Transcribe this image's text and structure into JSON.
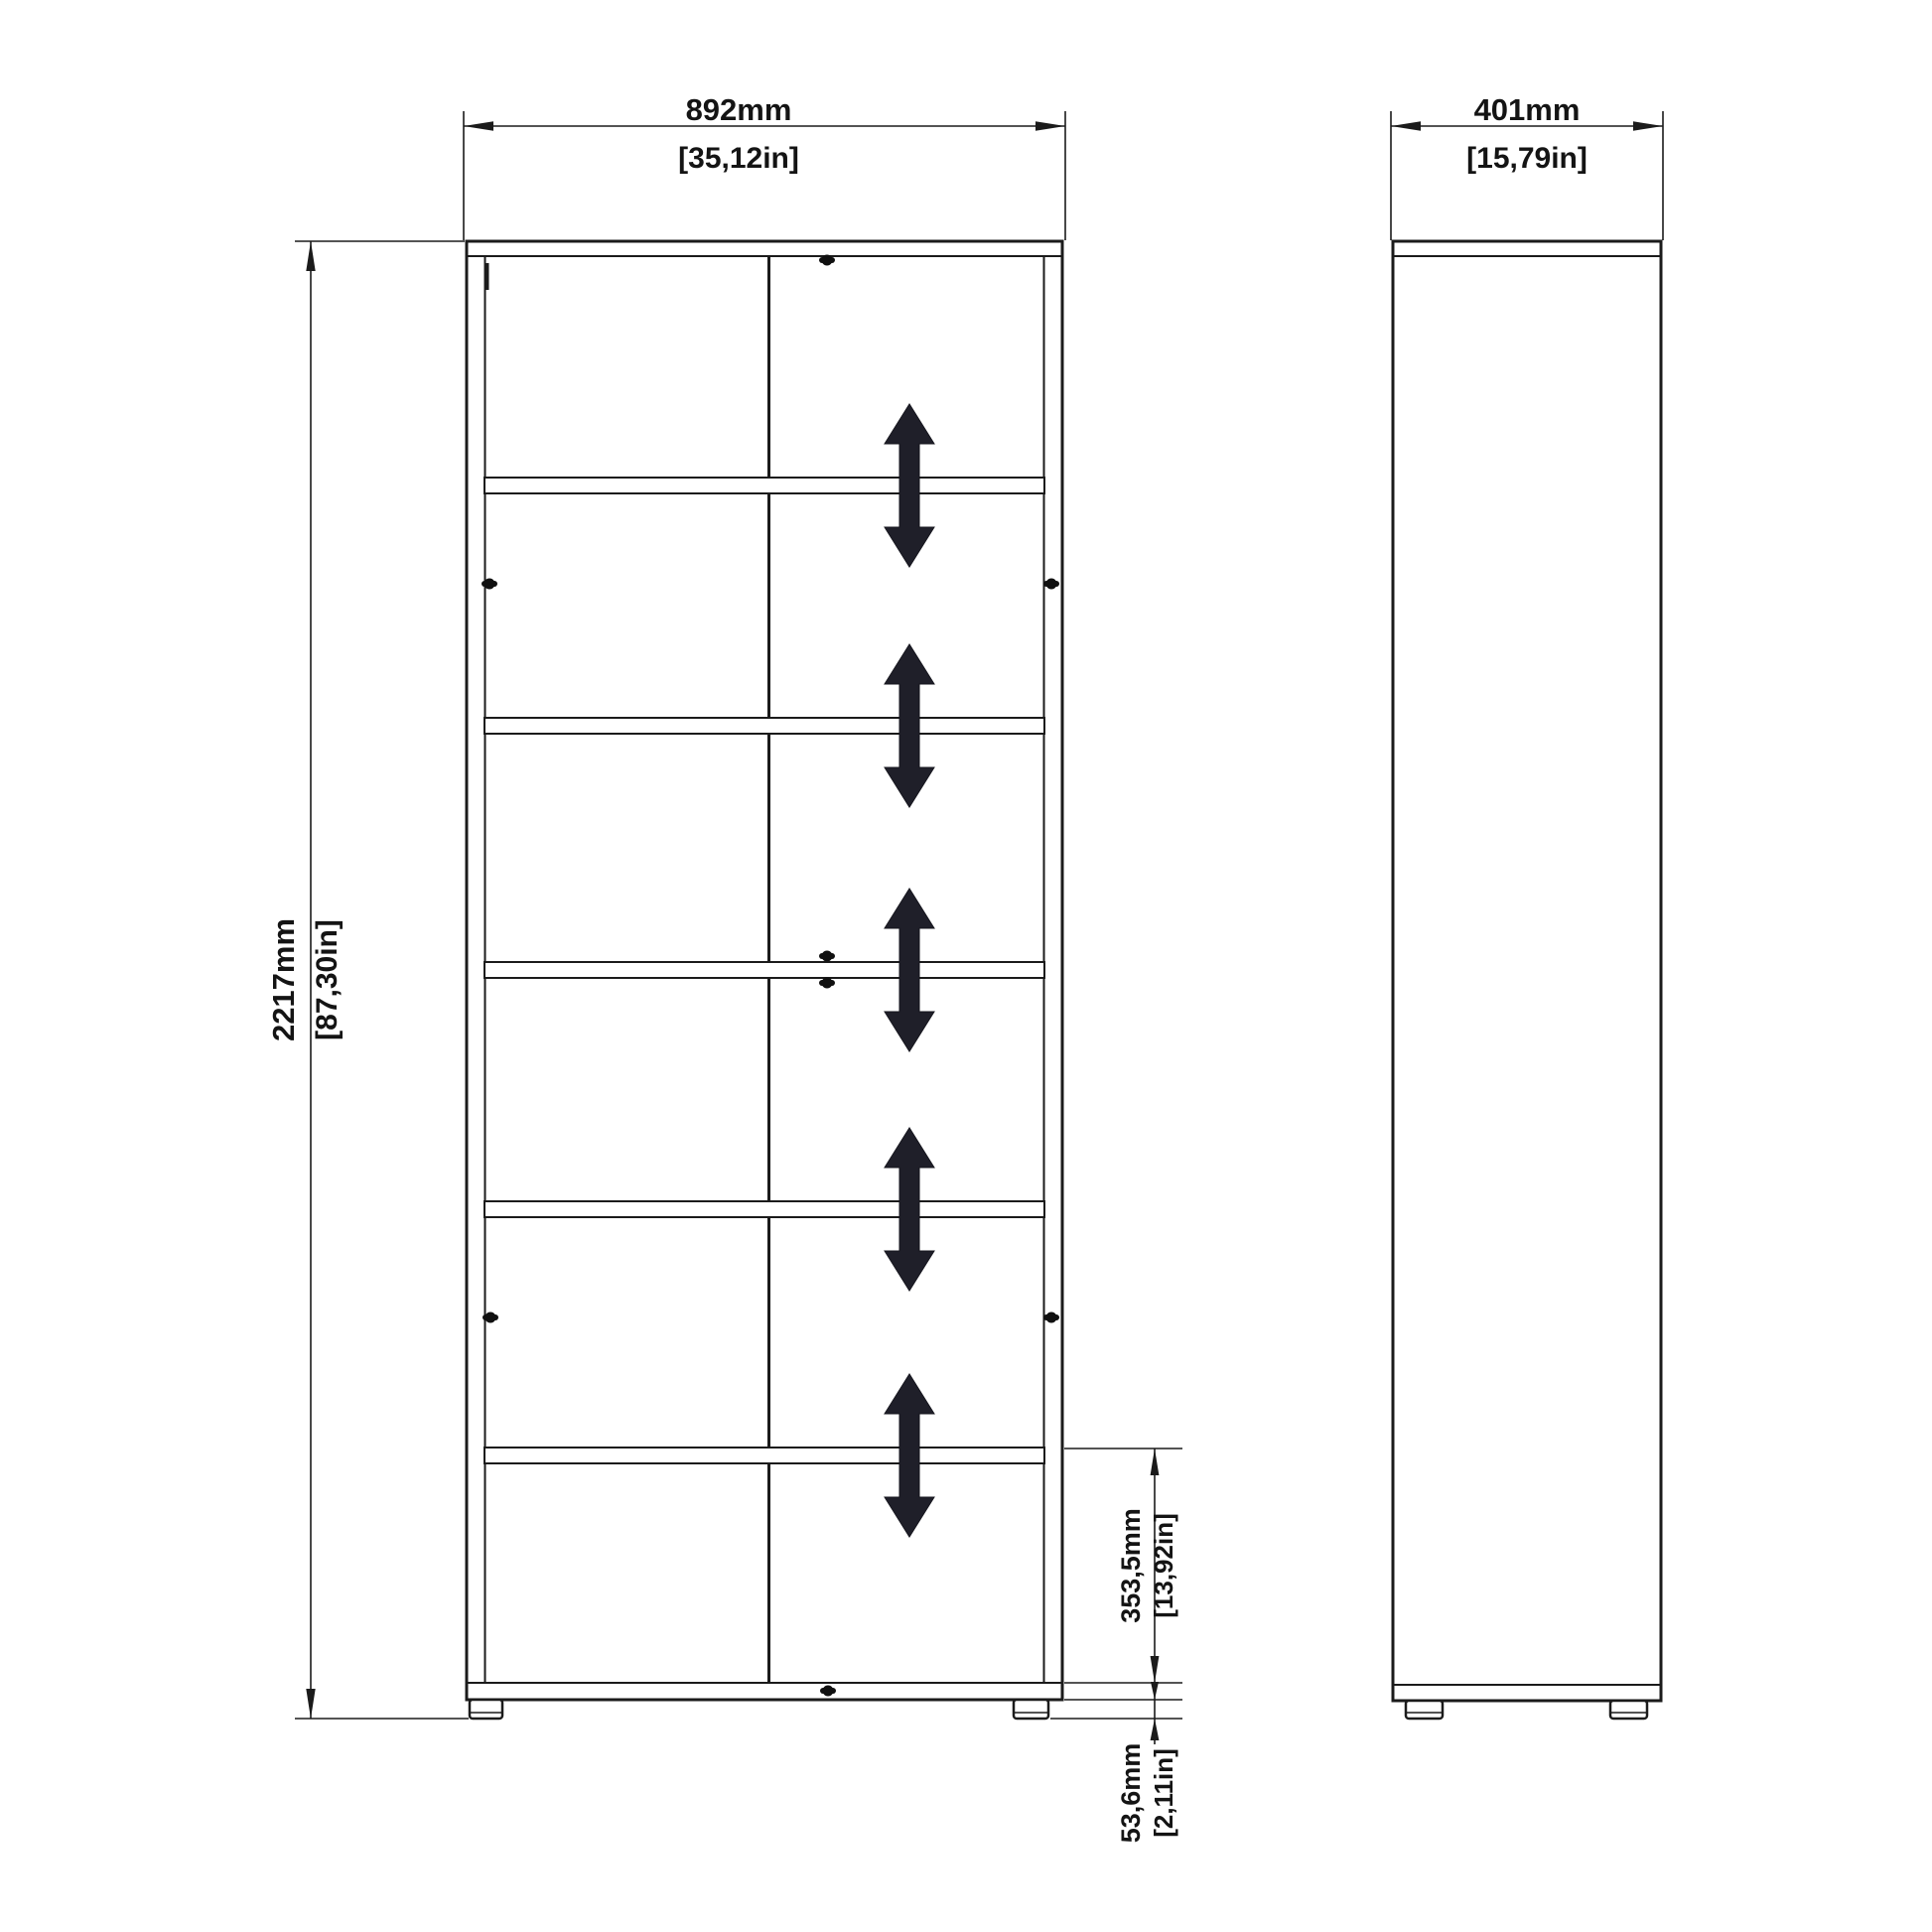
{
  "drawing": {
    "type": "furniture-technical-drawing",
    "views": {
      "front": {
        "name": "front-elevation",
        "shelf_count": 5,
        "adjustable_shelf_arrows": 5,
        "cam_screws": 8,
        "feet": 2
      },
      "side": {
        "name": "side-elevation",
        "feet": 2
      }
    },
    "dimensions": {
      "width": {
        "mm": "892mm",
        "inches": "[35,12in]"
      },
      "depth": {
        "mm": "401mm",
        "inches": "[15,79in]"
      },
      "height": {
        "mm": "2217mm",
        "inches": "[87,30in]"
      },
      "bottom_section": {
        "mm": "353,5mm",
        "inches": "[13,92in]"
      },
      "base_height": {
        "mm": "53,6mm",
        "inches": "[2,11in]"
      }
    },
    "colors": {
      "background": "#ffffff",
      "line": "#1b1b1b",
      "arrow_fill": "#1f1f29",
      "text": "#141414"
    },
    "icons": {
      "adjustable_arrow": "double-headed-vertical-arrow",
      "cam_screw": "cam-lock-screw",
      "dimension_arrow": "cad-dimension-arrowhead"
    }
  }
}
